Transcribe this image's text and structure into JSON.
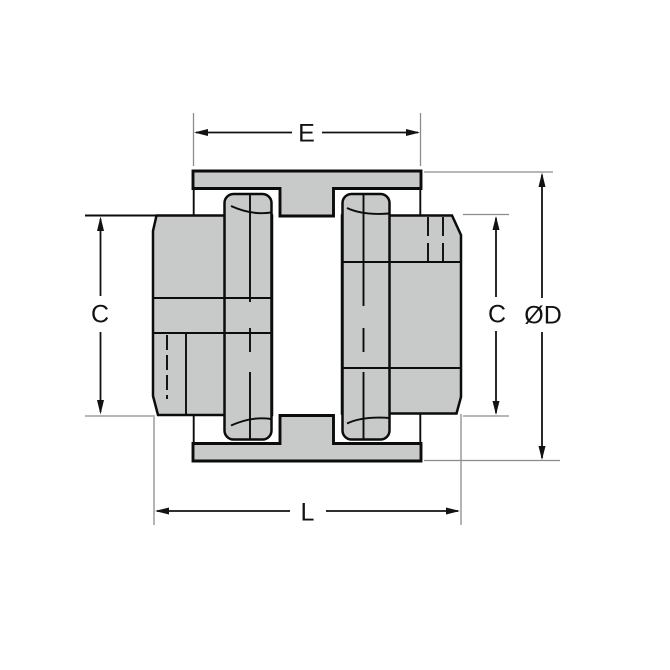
{
  "drawing": {
    "type": "engineering-cross-section",
    "component": "jaw-coupling-with-spider",
    "labels": {
      "width_e": "E",
      "hub_diameter_left": "C",
      "hub_diameter_right": "C",
      "outer_diameter": "ØD",
      "overall_length": "L"
    },
    "colors": {
      "part_fill": "#c8c9c9",
      "outline": "#0c0c0c",
      "dimension": "#121212",
      "extension": "#8c8c8c",
      "background": "#ffffff"
    }
  }
}
